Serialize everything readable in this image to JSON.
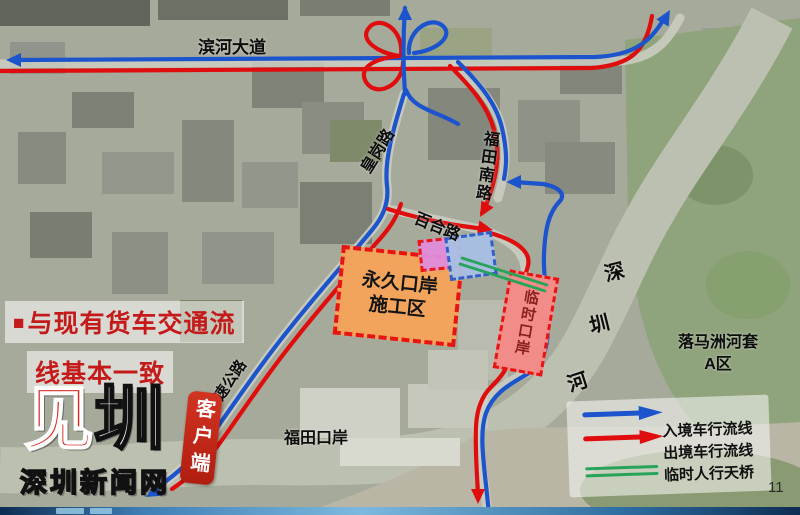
{
  "page": {
    "number": "11"
  },
  "annotation": {
    "bullet": "■",
    "line1": "与现有货车交通流",
    "line2": "线基本一致"
  },
  "labels": {
    "binhe_avenue": "滨河大道",
    "huanggang_road": "皇岗路",
    "futian_south_road": "福田南路",
    "baihe_road": "百合路",
    "expressway": "广深高速公路",
    "futian_port": "福田口岸",
    "shenzhen_river": {
      "c1": "深",
      "c2": "圳",
      "c3": "河"
    },
    "loop_area_line1": "落马洲河套",
    "loop_area_line2": "A区",
    "construction_zone_line1": "永久口岸",
    "construction_zone_line2": "施工区",
    "temporary_port": "临时口岸"
  },
  "legend": {
    "items": [
      {
        "icon": "blue-arrow",
        "label": "入境车行流线"
      },
      {
        "icon": "red-arrow",
        "label": "出境车行流线"
      },
      {
        "icon": "green-double-line",
        "label": "临时人行天桥"
      }
    ]
  },
  "branding": {
    "logo_main_c1": "见",
    "logo_main_c2": "圳",
    "logo_sub": "深圳新闻网",
    "client_badge": "客户端"
  },
  "colors": {
    "inbound_blue": "#1b54cc",
    "outbound_red": "#df0d0d",
    "footbridge_green": "#28a35a",
    "construction_fill": "#f2a45c",
    "construction_border": "#e81313",
    "annotation_red": "#c51a1a",
    "logo_red": "#d4281e",
    "badge_red": "#c5281c",
    "temp_port_fill": "#f28c88",
    "temp_port_text": "#8b1f1f",
    "pink_box": "#e18cdb",
    "blue_box": "#a9c0e4",
    "blue_box_border": "#2b5cc9"
  }
}
